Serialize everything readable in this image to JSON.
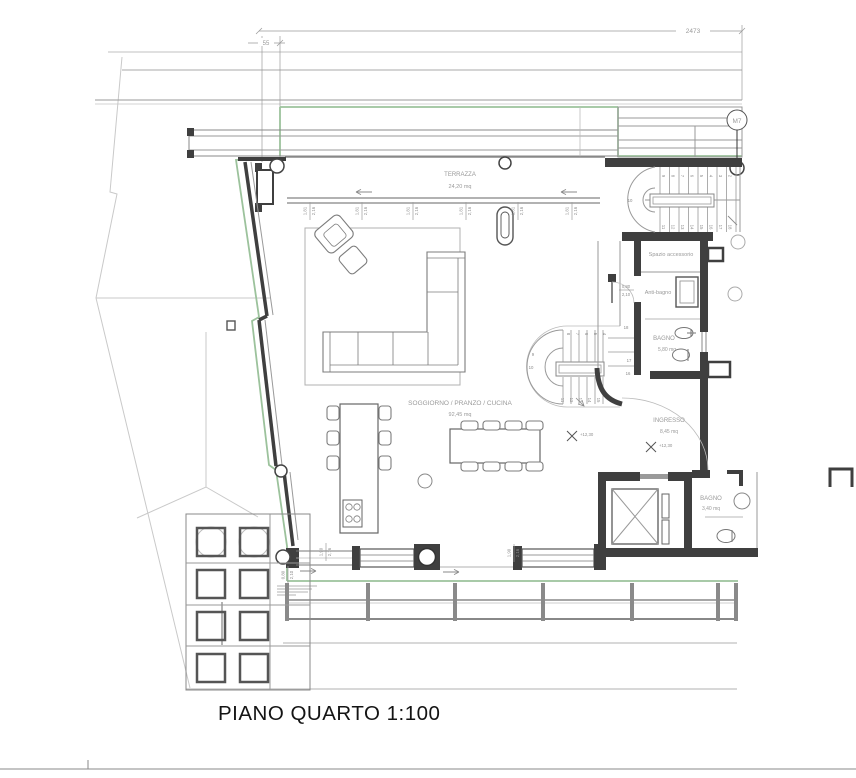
{
  "title": "PIANO QUARTO 1:100",
  "marker": {
    "label": "M7"
  },
  "dims": {
    "overall_width": "2473",
    "wall_offset": "55",
    "window_top": [
      "1,81",
      "2,16"
    ],
    "window_bottom": [
      "1,90",
      "2,16"
    ],
    "door": {
      "w": "0,80",
      "h": "2,10"
    },
    "door_corner": [
      "0,80",
      "2,10"
    ]
  },
  "levels": {
    "ingresso": "+12,30",
    "landing": "+12,30"
  },
  "rooms": {
    "terrazza": {
      "name": "TERRAZZA",
      "area": "24,20 mq"
    },
    "soggiorno": {
      "name": "SOGGIORNO / PRANZO / CUCINA",
      "area": "92,45 mq"
    },
    "spazio": {
      "name": "Spazio accessorio"
    },
    "antibagno": {
      "name": "Anti-bagno"
    },
    "bagno1": {
      "name": "BAGNO",
      "area": "5,80 mq"
    },
    "ingresso": {
      "name": "INGRESSO",
      "area": "8,45 mq"
    },
    "bagno2": {
      "name": "BAGNO",
      "area": "3,40 mq"
    }
  },
  "stairs": {
    "main": {
      "curve": "10",
      "top": [
        "9",
        "8",
        "7",
        "6",
        "5",
        "4",
        "3",
        "2"
      ],
      "bottom": [
        "11",
        "12",
        "13",
        "14",
        "15",
        "16",
        "17",
        "18"
      ]
    },
    "internal": {
      "top": [
        "8",
        "7",
        "6",
        "5",
        "4"
      ],
      "left": [
        "9",
        "10"
      ],
      "bottom": [
        "11",
        "12",
        "13",
        "14",
        "15"
      ],
      "right": [
        "18",
        "17",
        "16"
      ]
    }
  },
  "colors": {
    "green": "#9cc29c",
    "wall": "#3f3f3f",
    "line": "#8a8a8a",
    "faint": "#c9c9c9"
  }
}
